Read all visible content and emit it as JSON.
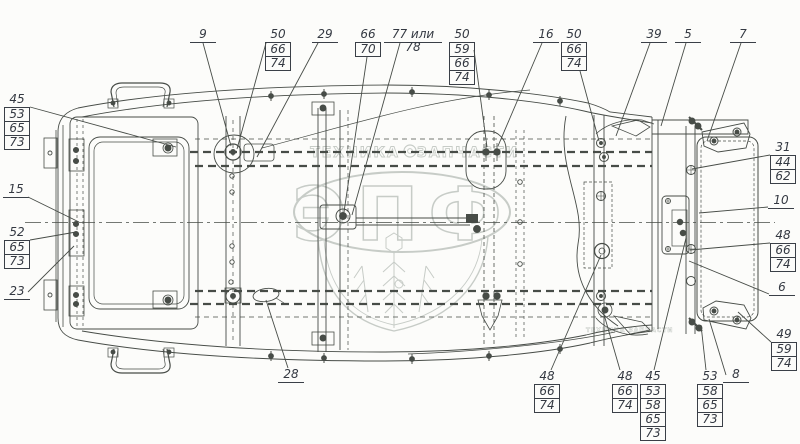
{
  "drawing": {
    "background": "#fcfcfa",
    "line_color": "#474c47",
    "callout_text_color": "#343942",
    "watermark_color": "#c7ccc7",
    "type": "vehicle body / platform frame top-view parts diagram"
  },
  "watermark": {
    "main": "ЭПФ",
    "band_left": "ТЕХНИКА",
    "band_right": "ЗАПЧАСТИ",
    "band_small": "ТЕХНИКА ЗАПЧАСТИ",
    "gear_icon": "gear-icon"
  },
  "callouts": [
    {
      "id": "9",
      "rows": [
        "9"
      ],
      "x": 190,
      "y": 28,
      "leader": [
        203,
        43,
        231,
        146
      ]
    },
    {
      "id": "50a",
      "rows": [
        "50",
        "66",
        "74"
      ],
      "x": 265,
      "y": 28,
      "leader": [
        266,
        43,
        237,
        149
      ]
    },
    {
      "id": "29",
      "rows": [
        "29"
      ],
      "x": 312,
      "y": 28,
      "leader": [
        318,
        43,
        257,
        157
      ]
    },
    {
      "id": "66-70",
      "rows": [
        "66",
        "70"
      ],
      "x": 355,
      "y": 28,
      "leader": [
        367,
        57,
        344,
        212
      ]
    },
    {
      "id": "77-78",
      "rows": [
        "77 или 78"
      ],
      "x": 384,
      "y": 28,
      "wide": true,
      "leader": [
        400,
        43,
        352,
        215
      ]
    },
    {
      "id": "50b",
      "rows": [
        "50",
        "59",
        "66",
        "74"
      ],
      "x": 449,
      "y": 28,
      "leader": [
        474,
        50,
        487,
        147
      ]
    },
    {
      "id": "16",
      "rows": [
        "16"
      ],
      "x": 533,
      "y": 28,
      "leader": [
        542,
        43,
        498,
        146
      ]
    },
    {
      "id": "50c",
      "rows": [
        "50",
        "66",
        "74"
      ],
      "x": 561,
      "y": 28,
      "leader": [
        580,
        71,
        599,
        141
      ]
    },
    {
      "id": "39",
      "rows": [
        "39"
      ],
      "x": 641,
      "y": 28,
      "leader": [
        650,
        43,
        616,
        136
      ]
    },
    {
      "id": "5",
      "rows": [
        "5"
      ],
      "x": 675,
      "y": 28,
      "leader": [
        686,
        43,
        661,
        126
      ]
    },
    {
      "id": "7",
      "rows": [
        "7"
      ],
      "x": 730,
      "y": 28,
      "leader": [
        741,
        43,
        707,
        141
      ]
    },
    {
      "id": "31",
      "rows": [
        "31",
        "44",
        "62"
      ],
      "x": 770,
      "y": 141,
      "leader": [
        770,
        155,
        692,
        169
      ]
    },
    {
      "id": "10",
      "rows": [
        "10"
      ],
      "x": 768,
      "y": 194,
      "leader": [
        768,
        207,
        699,
        213
      ]
    },
    {
      "id": "48r",
      "rows": [
        "48",
        "66",
        "74"
      ],
      "x": 770,
      "y": 229,
      "leader": [
        770,
        243,
        690,
        250
      ]
    },
    {
      "id": "6",
      "rows": [
        "6"
      ],
      "x": 769,
      "y": 281,
      "leader": [
        769,
        294,
        689,
        261
      ]
    },
    {
      "id": "49",
      "rows": [
        "49",
        "59",
        "74"
      ],
      "x": 771,
      "y": 328,
      "leader": [
        771,
        342,
        738,
        312
      ]
    },
    {
      "id": "8",
      "rows": [
        "8"
      ],
      "x": 723,
      "y": 368,
      "leader": [
        726,
        375,
        709,
        319
      ]
    },
    {
      "id": "45l",
      "rows": [
        "45",
        "53",
        "65",
        "73"
      ],
      "x": 4,
      "y": 93,
      "leader": [
        30,
        107,
        176,
        147
      ]
    },
    {
      "id": "15",
      "rows": [
        "15"
      ],
      "x": 3,
      "y": 183,
      "leader": [
        28,
        197,
        79,
        222
      ]
    },
    {
      "id": "52",
      "rows": [
        "52",
        "65",
        "73"
      ],
      "x": 4,
      "y": 226,
      "leader": [
        30,
        240,
        76,
        232
      ]
    },
    {
      "id": "23",
      "rows": [
        "23"
      ],
      "x": 4,
      "y": 285,
      "leader": [
        28,
        292,
        74,
        246
      ]
    },
    {
      "id": "28",
      "rows": [
        "28"
      ],
      "x": 278,
      "y": 368,
      "leader": [
        288,
        368,
        266,
        300
      ]
    },
    {
      "id": "48b1",
      "rows": [
        "48",
        "66",
        "74"
      ],
      "x": 534,
      "y": 370,
      "leader": [
        551,
        370,
        601,
        255
      ]
    },
    {
      "id": "48b2",
      "rows": [
        "48",
        "66",
        "74"
      ],
      "x": 612,
      "y": 370,
      "leader": [
        620,
        370,
        603,
        311
      ]
    },
    {
      "id": "45b",
      "rows": [
        "45",
        "53",
        "58",
        "65",
        "73"
      ],
      "x": 640,
      "y": 370,
      "leader": [
        654,
        370,
        686,
        238
      ]
    },
    {
      "id": "53b",
      "rows": [
        "53",
        "58",
        "65",
        "73"
      ],
      "x": 697,
      "y": 370,
      "leader": [
        706,
        370,
        701,
        325
      ]
    }
  ]
}
